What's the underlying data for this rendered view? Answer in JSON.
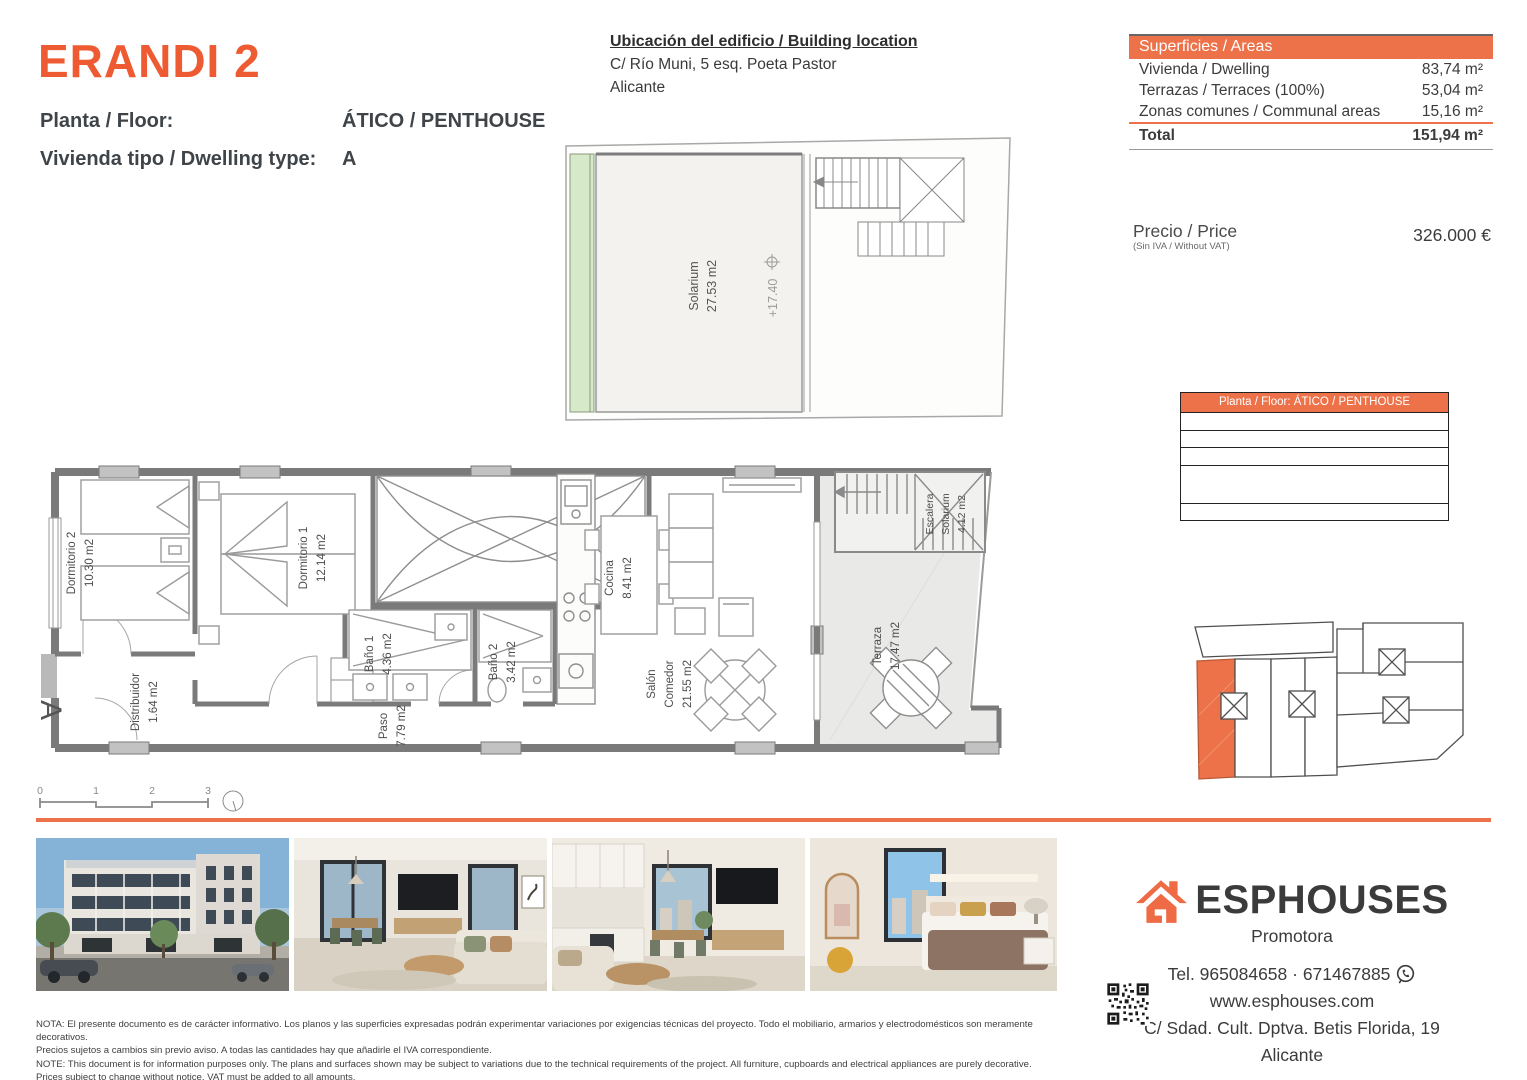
{
  "header": {
    "title": "ERANDI 2",
    "floor_label": "Planta / Floor:",
    "floor_value": "ÁTICO / PENTHOUSE",
    "type_label": "Vivienda tipo / Dwelling type:",
    "type_value": "A"
  },
  "location": {
    "heading": "Ubicación del edificio / Building location",
    "address": "C/ Río Muni, 5 esq. Poeta Pastor",
    "city": "Alicante"
  },
  "areas": {
    "heading": "Superficies / Areas",
    "rows": [
      {
        "label": "Vivienda / Dwelling",
        "value": "83,74 m²"
      },
      {
        "label": "Terrazas / Terraces (100%)",
        "value": "53,04 m²"
      },
      {
        "label": "Zonas comunes / Communal areas",
        "value": "15,16 m²"
      }
    ],
    "total_label": "Total",
    "total_value": "151,94 m²"
  },
  "price": {
    "label": "Precio / Price",
    "sublabel": "(Sin IVA / Without VAT)",
    "value": "326.000 €"
  },
  "floor_table": {
    "heading": "Planta / Floor: ÁTICO / PENTHOUSE"
  },
  "plan": {
    "section_marker": "A",
    "rooms": {
      "dormitorio2": {
        "name": "Dormitorio 2",
        "area": "10.30 m2"
      },
      "dormitorio1": {
        "name": "Dormitorio 1",
        "area": "12.14 m2"
      },
      "bano1": {
        "name": "Baño 1",
        "area": "4.36 m2"
      },
      "bano2": {
        "name": "Baño 2",
        "area": "3.42 m2"
      },
      "cocina": {
        "name": "Cocina",
        "area": "8.41 m2"
      },
      "salon": {
        "name": "Salón",
        "name2": "Comedor",
        "area": "21.55 m2"
      },
      "paso": {
        "name": "Paso",
        "area": "7.79 m2"
      },
      "distribuidor": {
        "name": "Distribuidor",
        "area": "1.64 m2"
      },
      "terraza": {
        "name": "Terraza",
        "area": "17.47 m2"
      },
      "escalera": {
        "name": "Escalera",
        "name2": "Solarium",
        "area": "4.12 m2"
      }
    },
    "scale_ticks": [
      "0",
      "1",
      "2",
      "3"
    ]
  },
  "solarium": {
    "name": "Solarium",
    "area": "27.53 m2",
    "level": "+17.40"
  },
  "notes": {
    "line1": "NOTA: El presente documento es de carácter informativo. Los planos y las superficies expresadas podrán experimentar variaciones por exigencias técnicas del proyecto. Todo el mobiliario, armarios y electrodomésticos son meramente decorativos.",
    "line2": "Precios sujetos a cambios sin previo aviso. A todas las cantidades hay que añadirle el IVA correspondiente.",
    "line3": "NOTE: This document is for information purposes only. The plans and surfaces shown may be subject to variations due to the technical requirements of the project. All furniture, cupboards and electrical appliances are purely decorative.",
    "line4": "Prices subject to change without notice. VAT must be added to all amounts."
  },
  "agency": {
    "name": "ESPHOUSES",
    "tagline": "Promotora",
    "phone": "Tel. 965084658 · 671467885",
    "web": "www.esphouses.com",
    "address": "C/ Sdad. Cult. Dptva. Betis Florida, 19",
    "city": "Alicante"
  },
  "colors": {
    "accent": "#EE5B33",
    "table_accent": "#ED7249"
  }
}
